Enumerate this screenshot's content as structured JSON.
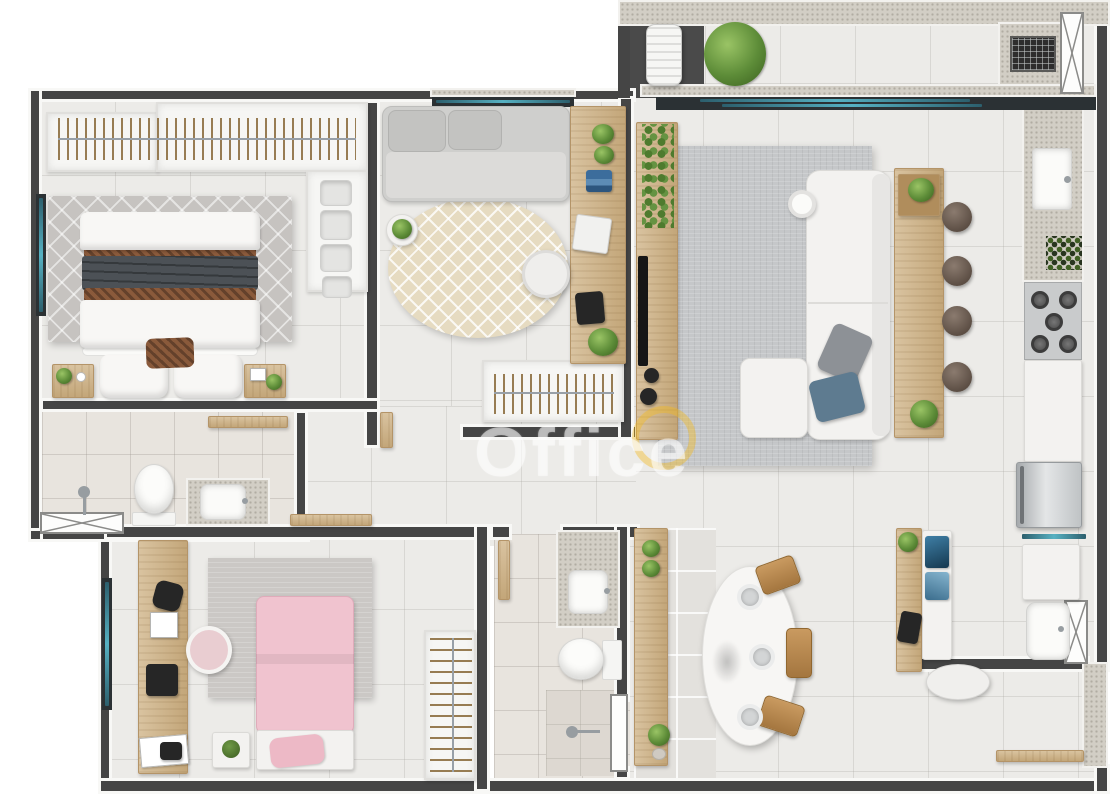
{
  "scene": {
    "type": "3d-floor-plan-top-view",
    "subject": "apartment"
  },
  "watermark": {
    "text": "Office",
    "logo_color": "#f3ba1e"
  },
  "palette": {
    "background": "#ffffff",
    "wall": "#454545",
    "wall_trim": "#f8f8f6",
    "floor_main": "#ecebe8",
    "floor_bath": "#e8e4de",
    "granite": "#d2cec5",
    "wood": "#d9c3a0",
    "wood_dark": "#c3a679",
    "glass_teal": "#56b1c2",
    "rug_gray": "#c6c3c0",
    "rug_living": "#c5c7c9",
    "rug_beige": "#e6dbc1",
    "plant_green": "#5d8c38",
    "bed_white": "#f3f2f0",
    "accent_brown": "#8a5a3b",
    "accent_dark": "#4c5156",
    "kids_pink": "#f0c3cf",
    "stool_brown": "#5c4e44",
    "appliance_steel": "#c2c5c7"
  },
  "rooms": [
    {
      "id": "master-bedroom",
      "furniture": [
        "wardrobe-rail-hangers",
        "folded-linen-stacks",
        "double-bed",
        "brown-bed-runners",
        "dark-throw-blanket",
        "accent-pillow",
        "diamond-pattern-rug",
        "nightstand-with-plant",
        "nightstand-with-frame",
        "window"
      ]
    },
    {
      "id": "ensuite-bathroom",
      "furniture": [
        "shower-head",
        "toilet",
        "granite-vanity-sink",
        "wood-shelf",
        "x-window"
      ]
    },
    {
      "id": "office-guest-room",
      "furniture": [
        "daybed-sofa",
        "round-patterned-rug",
        "side-table-with-plant",
        "wood-desk",
        "desk-chair",
        "laptop",
        "books",
        "tablet",
        "plants",
        "wardrobe-rail-hangers",
        "window"
      ]
    },
    {
      "id": "living-room",
      "furniture": [
        "tv-panel",
        "tv",
        "trailing-plant",
        "gray-area-rug",
        "white-sectional-sofa",
        "ottoman",
        "gray-pillow",
        "blue-pillow",
        "round-side-table",
        "wood-console-bar",
        "bar-stools-x4"
      ]
    },
    {
      "id": "kitchen",
      "furniture": [
        "granite-counter",
        "sink",
        "spice-rack",
        "gas-cooktop-5-burners",
        "white-base-cabinet",
        "refrigerator"
      ]
    },
    {
      "id": "balcony-grill",
      "furniture": [
        "air-conditioner-unit",
        "potted-plant",
        "granite-grill-counter",
        "built-in-grill",
        "x-window",
        "sliding-glass-door"
      ]
    },
    {
      "id": "dining-area",
      "furniture": [
        "oval-dining-table",
        "place-settings-x3",
        "centerpiece",
        "wood-chairs-x3",
        "wood-sideboard-with-plants",
        "tiled-walkway"
      ]
    },
    {
      "id": "laundry-area",
      "furniture": [
        "glass-shelf",
        "white-cabinet",
        "laundry-tub",
        "x-window"
      ]
    },
    {
      "id": "home-office-nook",
      "furniture": [
        "wood-desk",
        "white-hutch",
        "laptop",
        "desk-chair",
        "plant"
      ]
    },
    {
      "id": "kids-bedroom",
      "furniture": [
        "wood-desk",
        "speaker",
        "photo-frames",
        "printer",
        "blush-desk-chair",
        "gray-rug",
        "pink-single-bed",
        "pink-pillow",
        "bedside-table",
        "wardrobe-rail-hangers",
        "window"
      ]
    },
    {
      "id": "bathroom-2",
      "furniture": [
        "granite-vanity-sink",
        "toilet",
        "shower",
        "window",
        "wood-door"
      ]
    },
    {
      "id": "entry-hall",
      "furniture": [
        "granite-column",
        "wood-bench"
      ]
    }
  ]
}
